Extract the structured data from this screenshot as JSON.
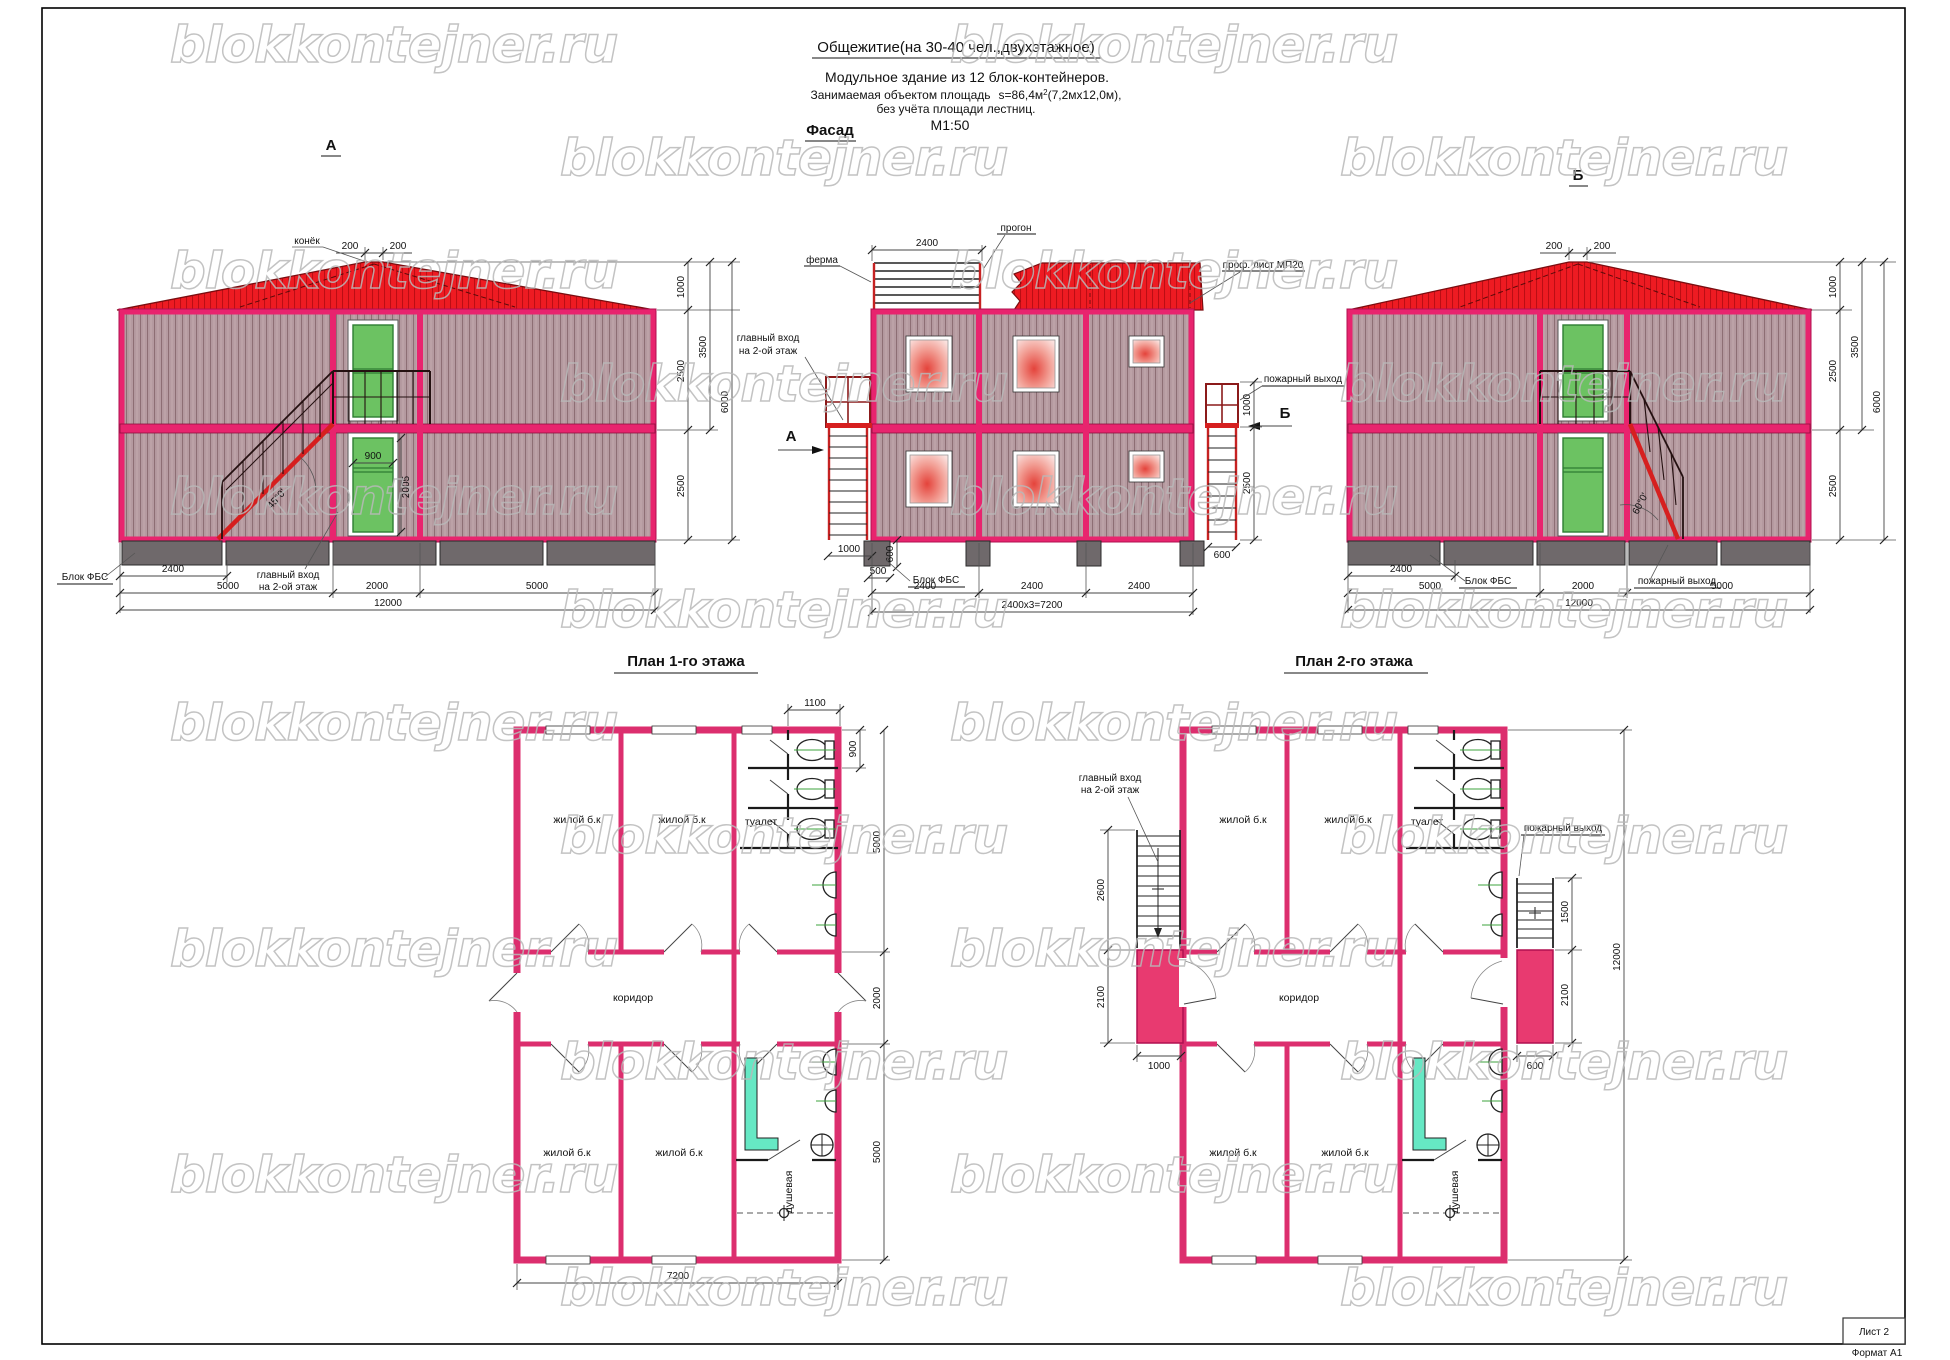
{
  "watermark": "blokkontejner.ru",
  "header": {
    "title": "Общежитие(на 30-40 чел.,двухэтажное)",
    "subtitle": "Модульное  здание из 12 блок-контейнеров.",
    "area_prefix": "Занимаемая объектом площадь",
    "area_value": "s=86,4м",
    "area_sup": "2",
    "area_suffix": "(7,2мх12,0м),",
    "area_note": "без учёта площади лестниц.",
    "scale": "М1:50"
  },
  "view_a": {
    "title": "А",
    "ridge_label": "конёк",
    "ridge_left": "200",
    "ridge_right": "200",
    "door_width": "900",
    "door_height": "2005",
    "stair_angle": "45°0'",
    "fbs_label": "Блок ФБС",
    "entry_line1": "главный вход",
    "entry_line2": "на 2-ой этаж",
    "dim_2400": "2400",
    "dim_5000_left": "5000",
    "dim_2000": "2000",
    "dim_5000_right": "5000",
    "dim_12000": "12000",
    "dim_1000": "1000",
    "dim_2500_up": "2500",
    "dim_2500_low": "2500",
    "dim_3500": "3500",
    "dim_6000": "6000"
  },
  "facade": {
    "title": "Фасад",
    "truss_label": "ферма",
    "purlin_label": "прогон",
    "sheet_label": "проф. лист МП20",
    "dim_2400_top": "2400",
    "entry_line1": "главный вход",
    "entry_line2": "на 2-ой этаж",
    "marker_a": "А",
    "marker_b": "Б",
    "fire_exit": "пожарный выход",
    "fbs_label": "Блок ФБС",
    "dim_1000_left": "1000",
    "dim_600_left": "600",
    "dim_500": "500",
    "dim_1000_right": "1000",
    "dim_2500_right": "2500",
    "dim_600_right": "600",
    "dim_2400_1": "2400",
    "dim_2400_2": "2400",
    "dim_2400_3": "2400",
    "dim_total": "2400х3=7200"
  },
  "view_b": {
    "title": "Б",
    "ridge_left": "200",
    "ridge_right": "200",
    "stair_angle": "60°0'",
    "fbs_label": "Блок ФБС",
    "fire_exit": "пожарный выход",
    "dim_2400": "2400",
    "dim_5000_left": "5000",
    "dim_2000": "2000",
    "dim_5000_right": "5000",
    "dim_12000": "12000",
    "dim_1000": "1000",
    "dim_2500_up": "2500",
    "dim_2500_low": "2500",
    "dim_3500": "3500",
    "dim_6000": "6000"
  },
  "plan1": {
    "title": "План  1-го этажа",
    "room_tl": "жилой б.к",
    "room_tm": "жилой б.к",
    "room_toilet": "туалет",
    "corridor": "коридор",
    "room_bl": "жилой б.к",
    "room_bm": "жилой б.к",
    "shower": "душевая",
    "dim_1100": "1100",
    "dim_900": "900",
    "dim_5000_top": "5000",
    "dim_2000": "2000",
    "dim_5000_bot": "5000",
    "dim_7200": "7200"
  },
  "plan2": {
    "title": "План  2-го этажа",
    "entry_line1": "главный вход",
    "entry_line2": "на 2-ой этаж",
    "fire_exit": "пожарный выход",
    "room_tl": "жилой б.к",
    "room_tm": "жилой б.к",
    "room_toilet": "туалет",
    "corridor": "коридор",
    "room_bl": "жилой б.к",
    "room_bm": "жилой б.к",
    "shower": "душевая",
    "dim_2600": "2600",
    "dim_2100_left": "2100",
    "dim_1000": "1000",
    "dim_1500": "1500",
    "dim_2100_right": "2100",
    "dim_600": "600",
    "dim_12000": "12000"
  },
  "footer": {
    "sheet": "Лист 2",
    "format": "Формат А1"
  },
  "colors": {
    "frame_pink": "#e8246e",
    "roof_red": "#ec1c24",
    "door_green": "#6cc262",
    "wall_crimson": "#dc2e6e"
  }
}
